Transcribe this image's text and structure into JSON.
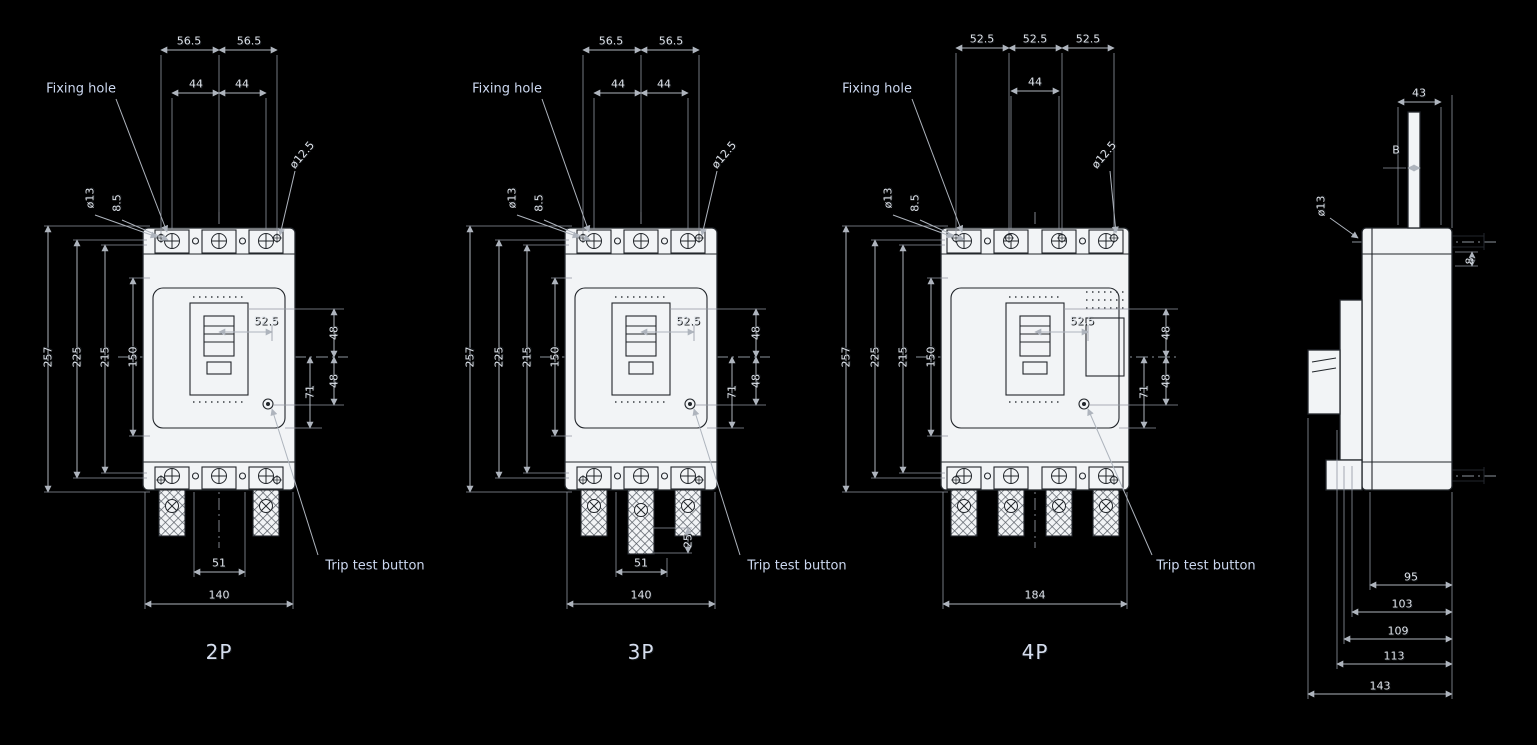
{
  "colors": {
    "background": "#000000",
    "dimension_lines": "#aeb4bd",
    "dimension_text": "#dde2e9",
    "product_fill": "#f2f4f6",
    "product_lines": "#22262b",
    "callout_text": "#ccd8f0"
  },
  "views": {
    "p2": {
      "pole_label": "2P",
      "callout_fixing_hole": "Fixing hole",
      "callout_trip_test": "Trip test button",
      "dim_top_left_outer": "56.5",
      "dim_top_right_outer": "56.5",
      "dim_top_left_inner": "44",
      "dim_top_right_inner": "44",
      "dim_hole_dia": "ø12.5",
      "dim_terminal_dia": "ø13",
      "dim_terminal_thickness": "8.5",
      "dim_h_overall": "257",
      "dim_h_mount": "225",
      "dim_h_inner": "215",
      "dim_h_center": "150",
      "dim_handle_offset": "52.5",
      "dim_right_upper": "48",
      "dim_right_mid": "71",
      "dim_right_lower": "48",
      "dim_bottom_inner": "51",
      "dim_width": "140"
    },
    "p3": {
      "pole_label": "3P",
      "callout_fixing_hole": "Fixing hole",
      "callout_trip_test": "Trip test button",
      "dim_top_left_outer": "56.5",
      "dim_top_right_outer": "56.5",
      "dim_top_left_inner": "44",
      "dim_top_right_inner": "44",
      "dim_hole_dia": "ø12.5",
      "dim_terminal_dia": "ø13",
      "dim_terminal_thickness": "8.5",
      "dim_h_overall": "257",
      "dim_h_mount": "225",
      "dim_h_inner": "215",
      "dim_h_center": "150",
      "dim_handle_offset": "52.5",
      "dim_right_upper": "48",
      "dim_right_mid": "71",
      "dim_right_lower": "48",
      "dim_lug_ext": "25",
      "dim_bottom_inner": "51",
      "dim_width": "140"
    },
    "p4": {
      "pole_label": "4P",
      "callout_fixing_hole": "Fixing hole",
      "callout_trip_test": "Trip test button",
      "dim_top_1": "52.5",
      "dim_top_2": "52.5",
      "dim_top_3": "52.5",
      "dim_top_center": "44",
      "dim_hole_dia": "ø12.5",
      "dim_terminal_dia": "ø13",
      "dim_terminal_thickness": "8.5",
      "dim_h_overall": "257",
      "dim_h_mount": "225",
      "dim_h_inner": "215",
      "dim_h_center": "150",
      "dim_handle_offset": "52.5",
      "dim_right_upper": "48",
      "dim_right_mid": "71",
      "dim_right_lower": "48",
      "dim_width": "184"
    },
    "side": {
      "dim_width_top": "43",
      "dim_b": "B",
      "dim_terminal_dia": "ø13",
      "dim_plate": "8",
      "dim_depth_1": "95",
      "dim_depth_2": "103",
      "dim_depth_3": "109",
      "dim_depth_4": "113",
      "dim_depth_5": "143"
    }
  }
}
